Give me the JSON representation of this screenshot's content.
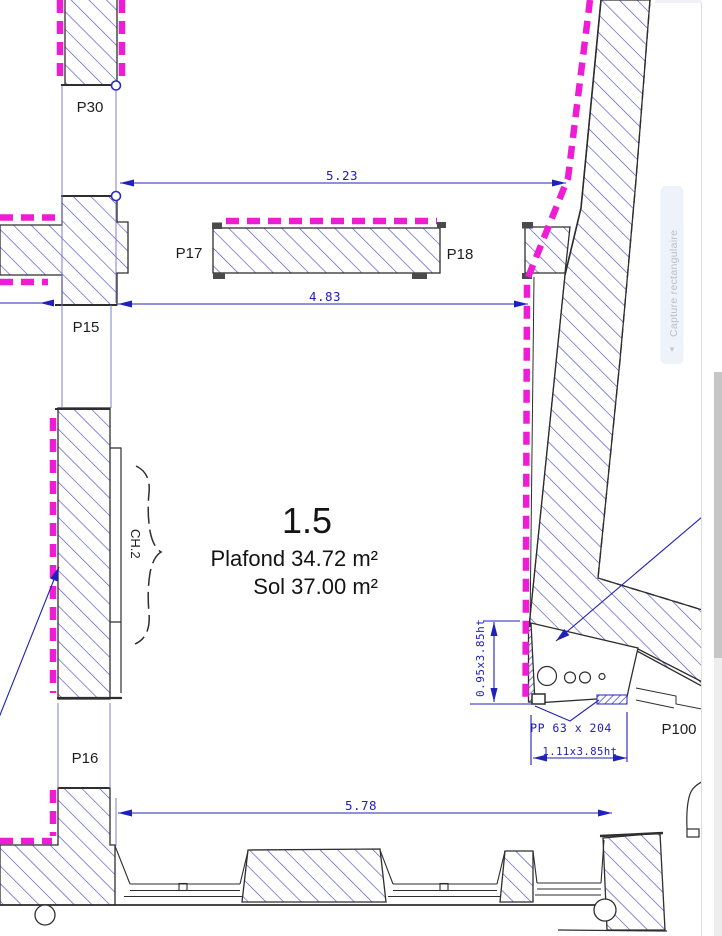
{
  "plan": {
    "openings": {
      "p30": "P30",
      "p17": "P17",
      "p18": "P18",
      "p15": "P15",
      "p16": "P16",
      "p100": "P100"
    },
    "window_label": "CH.2",
    "room": {
      "number": "1.5",
      "ceiling": "Plafond 34.72 m²",
      "floor": "Sol 37.00 m²"
    },
    "dimensions": {
      "top": "5.23",
      "middle": "4.83",
      "bottom": "5.78",
      "door_height": "0.95x3.85ht",
      "door_ref": "PP 63 x 204",
      "door_width": "1.11x3.85ht"
    }
  },
  "overlay": {
    "capture_button": "Capture rectangulaire",
    "chevron_icon": "▾"
  },
  "colors": {
    "demolition_magenta": "#ee1cd4",
    "dimension_blue": "#2020bb",
    "hatch_blue": "#4a4ac9",
    "line_dark": "#2e2e2e"
  }
}
